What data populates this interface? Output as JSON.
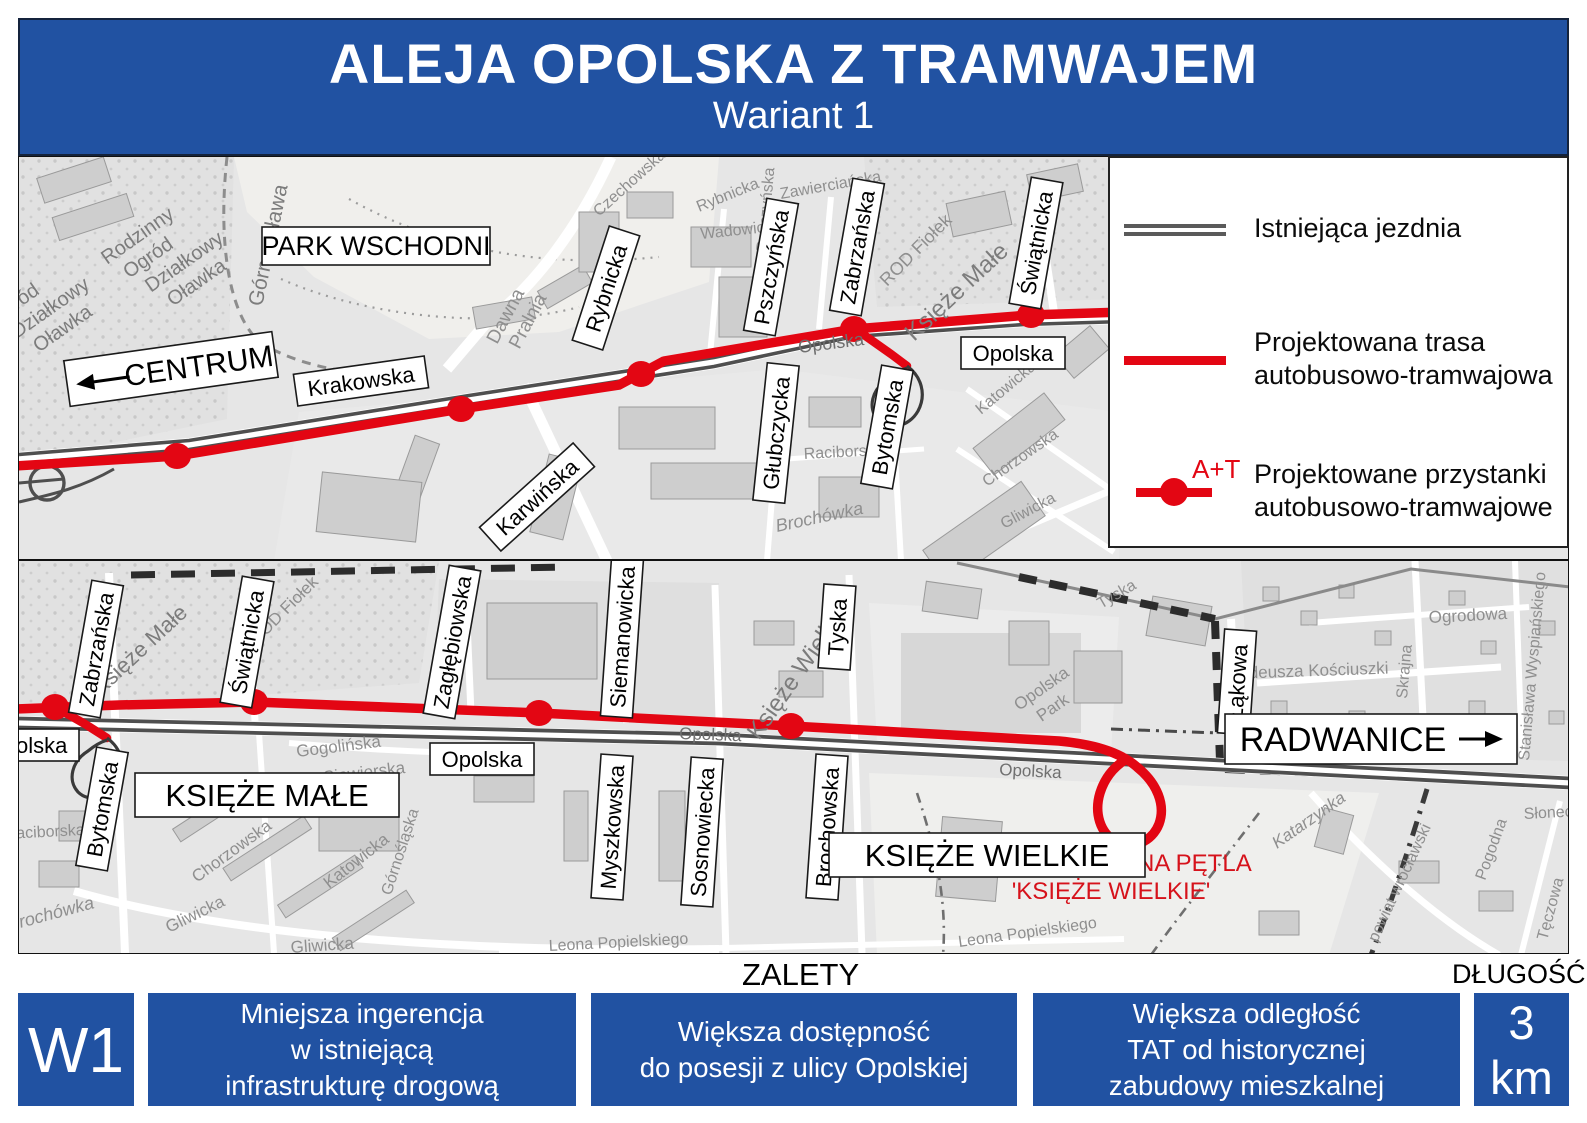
{
  "header": {
    "title": "ALEJA OPOLSKA Z TRAMWAJEM",
    "subtitle": "Wariant 1"
  },
  "colors": {
    "accent_blue": "#2152a2",
    "route_red": "#e30613",
    "road_gray": "#4f4f4f"
  },
  "legend": {
    "existing_road": "Istniejąca jezdnia",
    "planned_route_l1": "Projektowana trasa",
    "planned_route_l2": "autobusowo-tramwajowa",
    "stop_symbol": "A+T",
    "planned_stops_l1": "Projektowane przystanki",
    "planned_stops_l2": "autobusowo-tramwajowe"
  },
  "top_map": {
    "boxed": [
      "PARK WSCHODNI",
      "CENTRUM",
      "Krakowska",
      "Rybnicka",
      "Pszczyńska",
      "Zabrzańska",
      "Świątnicka",
      "Opolska",
      "Głubczycka",
      "Bytomska",
      "Karwińska"
    ],
    "bg": [
      "Rodzinny",
      "Ogród",
      "Działkowy",
      "Oławka",
      "Ogród",
      "Działkowy",
      "Oławka",
      "Górna Oława",
      "Dawna",
      "Pralnia",
      "Czechowska",
      "Rybnicka",
      "Wadowicka",
      "Zawierciańska",
      "Pszczyńska",
      "ROD Fiołek",
      "Księże Małe",
      "Opolska",
      "Katowicka",
      "Raciborska",
      "Chorzowska",
      "Gliwicka",
      "Brochówka"
    ]
  },
  "bottom_map": {
    "boxed": [
      "Zabrzańska",
      "Świątnicka",
      "Zagłębiowska",
      "Siemanowicka",
      "Tyska",
      "Bytomska",
      "Myszkowska",
      "Sosnowiecka",
      "Brochowska",
      "Łąkowa",
      "Opolska",
      "Opolska",
      "KSIĘŻE MAŁE",
      "KSIĘŻE WIELKIE",
      "RADWANICE"
    ],
    "red_note_l1": "PROJEKTOWANA PĘTLA",
    "red_note_l2": "'KSIĘŻE WIELKIE'",
    "bg": [
      "ROD Fiołek",
      "Księże Małe",
      "Gogolińska",
      "Siewierska",
      "Górnośląska",
      "Katowicka",
      "Chorzowska",
      "Gliwicka",
      "Gliwicka",
      "Raciborska",
      "Brochówka",
      "Opolska",
      "Opolska",
      "Księże Wielkie",
      "Tyska",
      "Opolska",
      "Park",
      "Leona Popielskiego",
      "Leona Popielskiego",
      "Tadeusza Kościuszki",
      "Ogrodowa",
      "Skrajna",
      "Stanisława Wyspiańskiego",
      "Katarzynka",
      "powiat wrocławski",
      "Pogodna",
      "Słoneczna",
      "Tęczowa"
    ]
  },
  "footer": {
    "advantages_title": "ZALETY",
    "length_title": "DŁUGOŚĆ",
    "variant_code": "W1",
    "advantages": [
      {
        "lines": [
          "Mniejsza ingerencja",
          "w istniejącą",
          "infrastrukturę drogową"
        ]
      },
      {
        "lines": [
          "Większa dostępność",
          "do posesji z ulicy Opolskiej"
        ]
      },
      {
        "lines": [
          "Większa odległość",
          "TAT od historycznej",
          "zabudowy mieszkalnej"
        ]
      }
    ],
    "length_value": "3 km"
  }
}
